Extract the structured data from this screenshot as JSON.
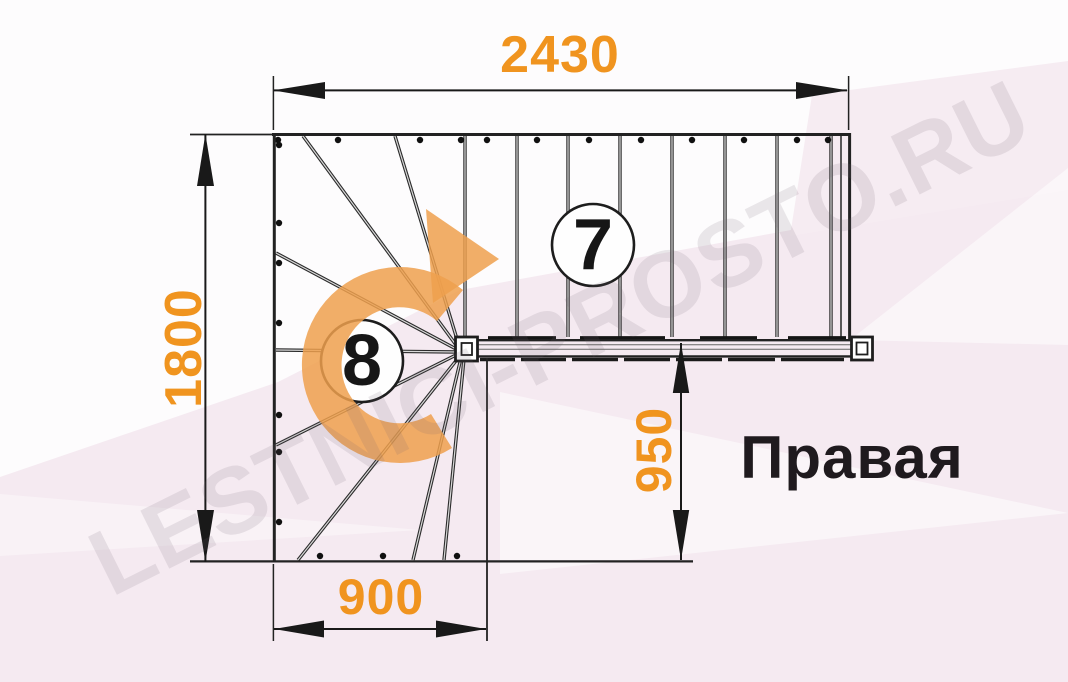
{
  "drawing": {
    "orientation_label": "Правая",
    "watermark": "LESTNICI-PROSTO.RU",
    "dimensions": {
      "top": "2430",
      "left": "1800",
      "bottom": "900",
      "right": "950"
    },
    "steps": {
      "straight_flight": "7",
      "winders": "8"
    },
    "colors": {
      "dimension_text": "#F0941F",
      "turn_arrow": "#EFA04E",
      "lines": "#2B2B2B",
      "background_pink": "#F5EAF1",
      "label_text": "#1F1A1E"
    }
  }
}
